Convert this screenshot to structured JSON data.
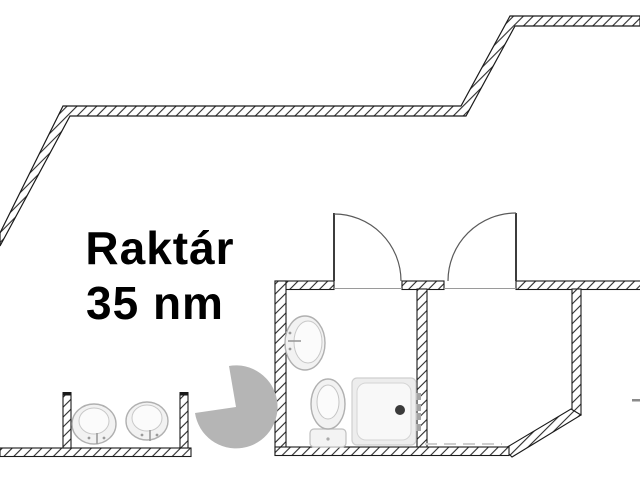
{
  "canvas": {
    "width": 640,
    "height": 480,
    "background": "#ffffff"
  },
  "room": {
    "label": "Raktár",
    "area": "35 nm"
  },
  "colors": {
    "wall_line": "#1a1a1a",
    "hatch_line": "#2b2b2b",
    "wall_fill": "#ffffff",
    "door_line": "#5a5a5a",
    "fixture_outline": "#b0b0b0",
    "fixture_fill": "#f2f2f2",
    "fixture_inner_fill": "#fbfbfb",
    "shower_drain": "#3a3a3a",
    "watermark_gray": "#b5b5b5",
    "label_text": "#000000"
  },
  "fixtures": {
    "bathroom": [
      "washbasin",
      "toilet",
      "shower-tray"
    ],
    "washroom": [
      "washbasin-left",
      "washbasin-right"
    ]
  },
  "doors": [
    "door-left-swing",
    "door-right-swing"
  ],
  "watermarks": [
    "pie-segment",
    "tower-fragment",
    "dash-fragment",
    "dashed-line-fragment"
  ]
}
